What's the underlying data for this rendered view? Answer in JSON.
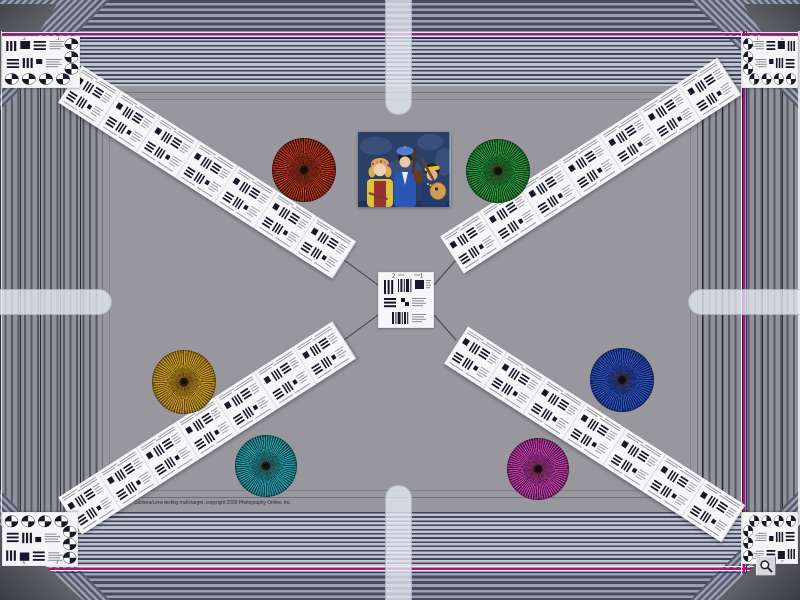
{
  "meta": {
    "description": "Camera lens resolution multi-target test chart photograph",
    "background_color": "#97979d",
    "accent_magenta": "#c1077b",
    "accent_navy": "#2b3272",
    "stripe_dark": "#474b5f",
    "stripe_light": "#bfc3cf"
  },
  "caption": {
    "text": "Camera/Lens testing multi-target, copyright 2009 Photography Online, Inc."
  },
  "card_labels": {
    "minus2": "-2",
    "minus1": "-1"
  },
  "center_card": {
    "x": 378,
    "y": 272,
    "w": 56,
    "h": 56,
    "labels": {
      "left": "2",
      "right": "1"
    }
  },
  "stars": [
    {
      "name": "red",
      "cx": 304,
      "cy": 170,
      "r": 32,
      "bright": "#bf3a1f",
      "dark": "#40100a"
    },
    {
      "name": "green",
      "cx": 498,
      "cy": 171,
      "r": 32,
      "bright": "#2e9e43",
      "dark": "#0b3b14"
    },
    {
      "name": "gold",
      "cx": 184,
      "cy": 382,
      "r": 32,
      "bright": "#cfa22a",
      "dark": "#63480c"
    },
    {
      "name": "blue",
      "cx": 622,
      "cy": 380,
      "r": 32,
      "bright": "#2f55c4",
      "dark": "#0d1f55"
    },
    {
      "name": "teal",
      "cx": 266,
      "cy": 466,
      "r": 31,
      "bright": "#2fa3ad",
      "dark": "#0c464e"
    },
    {
      "name": "magenta",
      "cx": 538,
      "cy": 469,
      "r": 31,
      "bright": "#c445ad",
      "dark": "#551049"
    }
  ],
  "strips": [
    {
      "name": "strip-top-left",
      "x": 70,
      "y": 84,
      "angle": 32.7,
      "length": 326,
      "units": 7
    },
    {
      "name": "strip-top-right",
      "x": 452,
      "y": 255,
      "angle": -32.8,
      "length": 330,
      "units": 7
    },
    {
      "name": "strip-bottom-left",
      "x": 70,
      "y": 516,
      "angle": -32.7,
      "length": 326,
      "units": 7
    },
    {
      "name": "strip-bottom-right",
      "x": 456,
      "y": 345,
      "angle": 32.8,
      "length": 330,
      "units": 7
    }
  ],
  "corner_cards": [
    {
      "name": "corner-card-top-left",
      "x": 2,
      "y": 36,
      "w": 78,
      "h": 52,
      "sx": 1,
      "sy": 1
    },
    {
      "name": "corner-card-top-right",
      "x": 742,
      "y": 36,
      "w": 56,
      "h": 52,
      "sx": -1,
      "sy": 1
    },
    {
      "name": "corner-card-bottom-left",
      "x": 2,
      "y": 512,
      "w": 76,
      "h": 54,
      "sx": 1,
      "sy": -1
    },
    {
      "name": "corner-card-bottom-right",
      "x": 742,
      "y": 512,
      "w": 56,
      "h": 52,
      "sx": -1,
      "sy": -1
    }
  ],
  "connector_lines": [
    [
      344,
      260,
      378,
      285
    ],
    [
      456,
      260,
      434,
      285
    ],
    [
      344,
      340,
      378,
      315
    ],
    [
      456,
      340,
      434,
      315
    ]
  ],
  "photo": {
    "subject": "three costumed musicians with string instruments on blue background",
    "x": 358,
    "y": 132,
    "w": 93,
    "h": 75
  },
  "zoom_button": {
    "icon": "magnifier-icon",
    "action": "enlarge image"
  }
}
